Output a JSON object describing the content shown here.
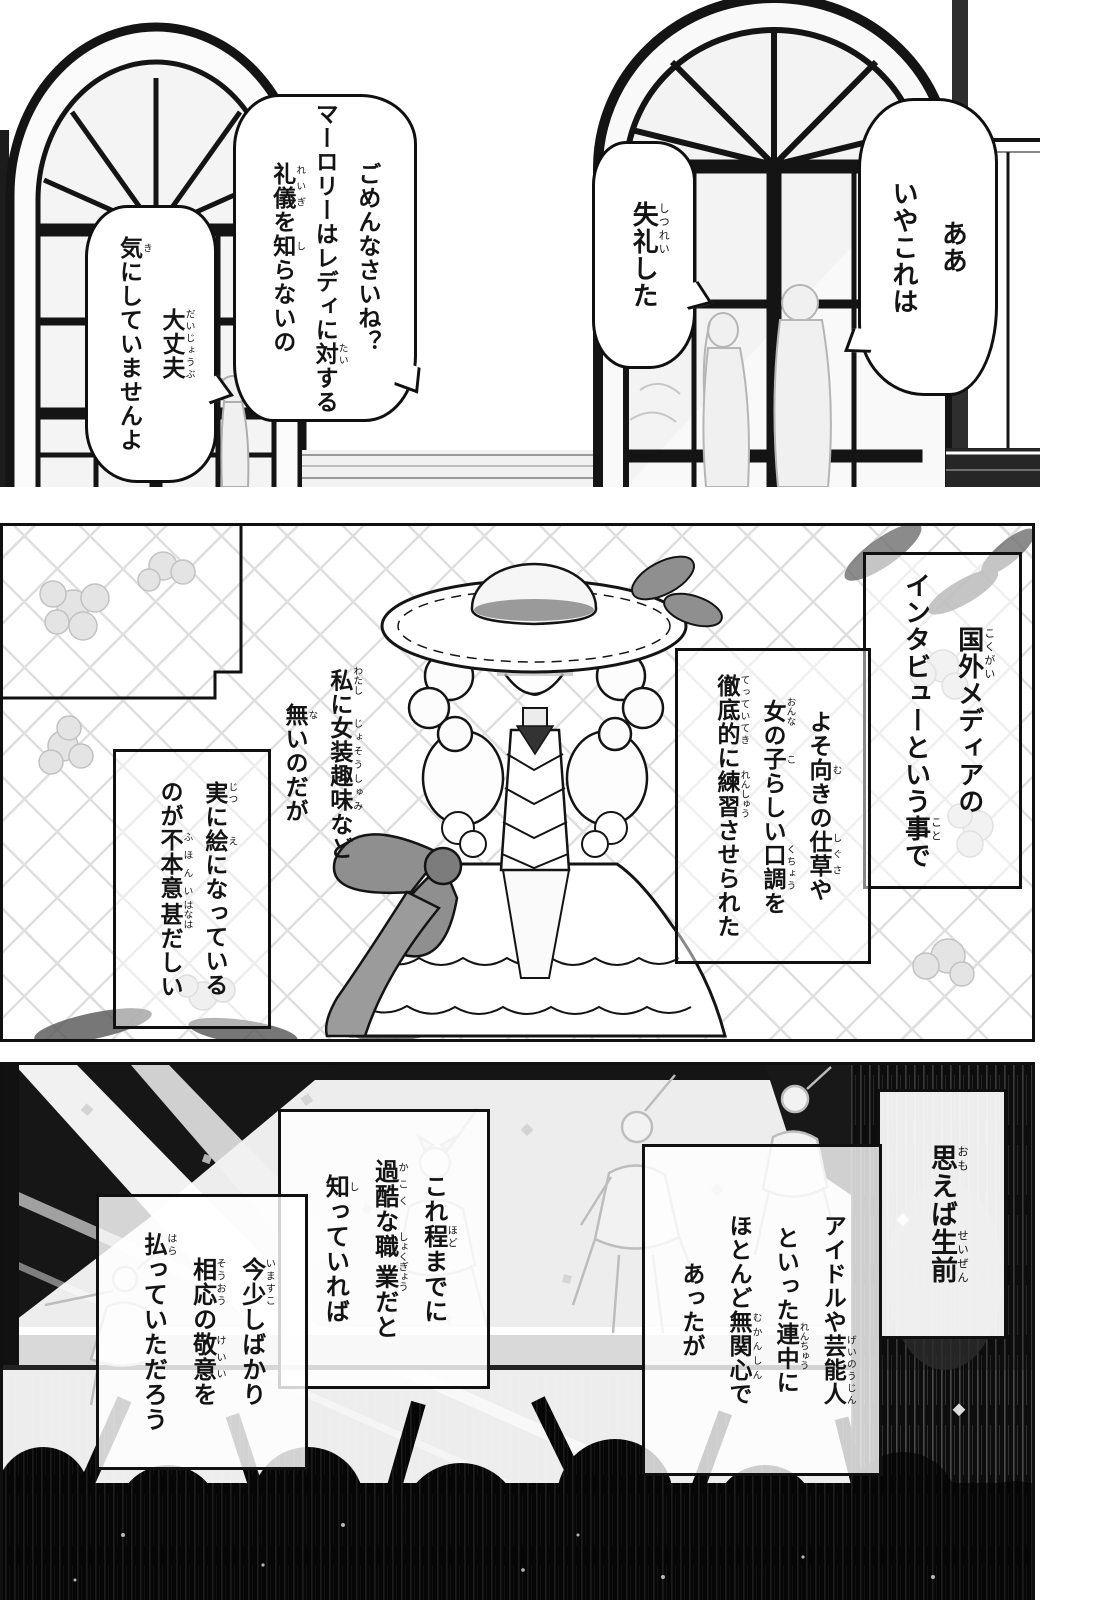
{
  "colors": {
    "ink": "#101010",
    "paper": "#ffffff",
    "crowd_black": "#060606",
    "bow_gray": "#8f8f8f"
  },
  "panel1": {
    "bubbles": [
      {
        "id": "bubble-aa-iya-koreha",
        "segments": [
          {
            "t": "ああ"
          },
          {
            "br": true
          },
          {
            "t": "いやこれは"
          }
        ]
      },
      {
        "id": "bubble-shitsurei",
        "segments": [
          {
            "t": "失礼",
            "r": "しつれい"
          },
          {
            "t": "した"
          }
        ]
      },
      {
        "id": "bubble-gomennasai",
        "segments": [
          {
            "t": "ごめんなさいね？"
          },
          {
            "br": true
          },
          {
            "t": "マーロリーはレディに"
          },
          {
            "t": "対",
            "r": "たい"
          },
          {
            "t": "する"
          },
          {
            "br": true
          },
          {
            "t": "礼儀",
            "r": "れいぎ"
          },
          {
            "t": "を"
          },
          {
            "t": "知",
            "r": "し"
          },
          {
            "t": "らないの"
          }
        ]
      },
      {
        "id": "bubble-daijoubu",
        "segments": [
          {
            "t": "大丈夫",
            "r": "だいじょうぶ"
          },
          {
            "br": true
          },
          {
            "t": "気",
            "r": "き"
          },
          {
            "t": "にしていませんよ"
          }
        ]
      }
    ]
  },
  "panel2": {
    "captions": [
      {
        "id": "caption-kokugai",
        "segments": [
          {
            "t": "国外",
            "r": "こくがい"
          },
          {
            "t": "メディアの"
          },
          {
            "br": true
          },
          {
            "t": "インタビューという"
          },
          {
            "t": "事",
            "r": "こと"
          },
          {
            "t": "で"
          }
        ]
      },
      {
        "id": "caption-yosomuki",
        "segments": [
          {
            "t": "よそ"
          },
          {
            "t": "向",
            "r": "む"
          },
          {
            "t": "きの"
          },
          {
            "t": "仕草",
            "r": "しぐさ"
          },
          {
            "t": "や"
          },
          {
            "br": true
          },
          {
            "t": "女",
            "r": "おんな"
          },
          {
            "t": "の"
          },
          {
            "t": "子",
            "r": "こ"
          },
          {
            "t": "らしい"
          },
          {
            "t": "口調",
            "r": "くちょう"
          },
          {
            "t": "を"
          },
          {
            "br": true
          },
          {
            "t": "徹底的",
            "r": "てっていてき"
          },
          {
            "t": "に"
          },
          {
            "t": "練習",
            "r": "れんしゅう"
          },
          {
            "t": "させられた"
          }
        ]
      },
      {
        "id": "caption-watashi",
        "segments": [
          {
            "t": "私",
            "r": "わたし"
          },
          {
            "t": "に"
          },
          {
            "t": "女装趣味",
            "r": "じょそうしゅみ"
          },
          {
            "t": "など"
          },
          {
            "br": true
          },
          {
            "t": "無",
            "r": "な"
          },
          {
            "t": "いのだが"
          }
        ]
      },
      {
        "id": "caption-jitsuni",
        "segments": [
          {
            "t": "実",
            "r": "じつ"
          },
          {
            "t": "に"
          },
          {
            "t": "絵",
            "r": "え"
          },
          {
            "t": "になっている"
          },
          {
            "br": true
          },
          {
            "t": "のが"
          },
          {
            "t": "不本意",
            "r": "ふほんい"
          },
          {
            "t": "甚",
            "r": "はなは"
          },
          {
            "t": "だしい"
          }
        ]
      }
    ]
  },
  "panel3": {
    "captions": [
      {
        "id": "caption-omoeba",
        "segments": [
          {
            "t": "思",
            "r": "おも"
          },
          {
            "t": "えば"
          },
          {
            "t": "生前",
            "r": "せいぜん"
          }
        ]
      },
      {
        "id": "caption-idol",
        "segments": [
          {
            "t": "アイドルや"
          },
          {
            "t": "芸能人",
            "r": "げいのうじん"
          },
          {
            "br": true
          },
          {
            "t": "といった"
          },
          {
            "t": "連中",
            "r": "れんちゅう"
          },
          {
            "t": "に"
          },
          {
            "br": true
          },
          {
            "t": "ほとんど"
          },
          {
            "t": "無関心",
            "r": "むかんしん"
          },
          {
            "t": "で"
          },
          {
            "br": true
          },
          {
            "t": "あったが"
          }
        ]
      },
      {
        "id": "caption-korehodo",
        "segments": [
          {
            "t": "これ"
          },
          {
            "t": "程",
            "r": "ほど"
          },
          {
            "t": "までに"
          },
          {
            "br": true
          },
          {
            "t": "過酷",
            "r": "かこく"
          },
          {
            "t": "な"
          },
          {
            "t": "職業",
            "r": "しょくぎょう"
          },
          {
            "t": "だと"
          },
          {
            "br": true
          },
          {
            "t": "知",
            "r": "し"
          },
          {
            "t": "っていれば"
          }
        ]
      },
      {
        "id": "caption-imasukoshi",
        "segments": [
          {
            "t": "今少",
            "r": "いますこ"
          },
          {
            "t": "しばかり"
          },
          {
            "br": true
          },
          {
            "t": "相応",
            "r": "そうおう"
          },
          {
            "t": "の"
          },
          {
            "t": "敬意",
            "r": "けいい"
          },
          {
            "t": "を"
          },
          {
            "br": true
          },
          {
            "t": "払",
            "r": "はら"
          },
          {
            "t": "っていただろう"
          }
        ]
      }
    ]
  }
}
